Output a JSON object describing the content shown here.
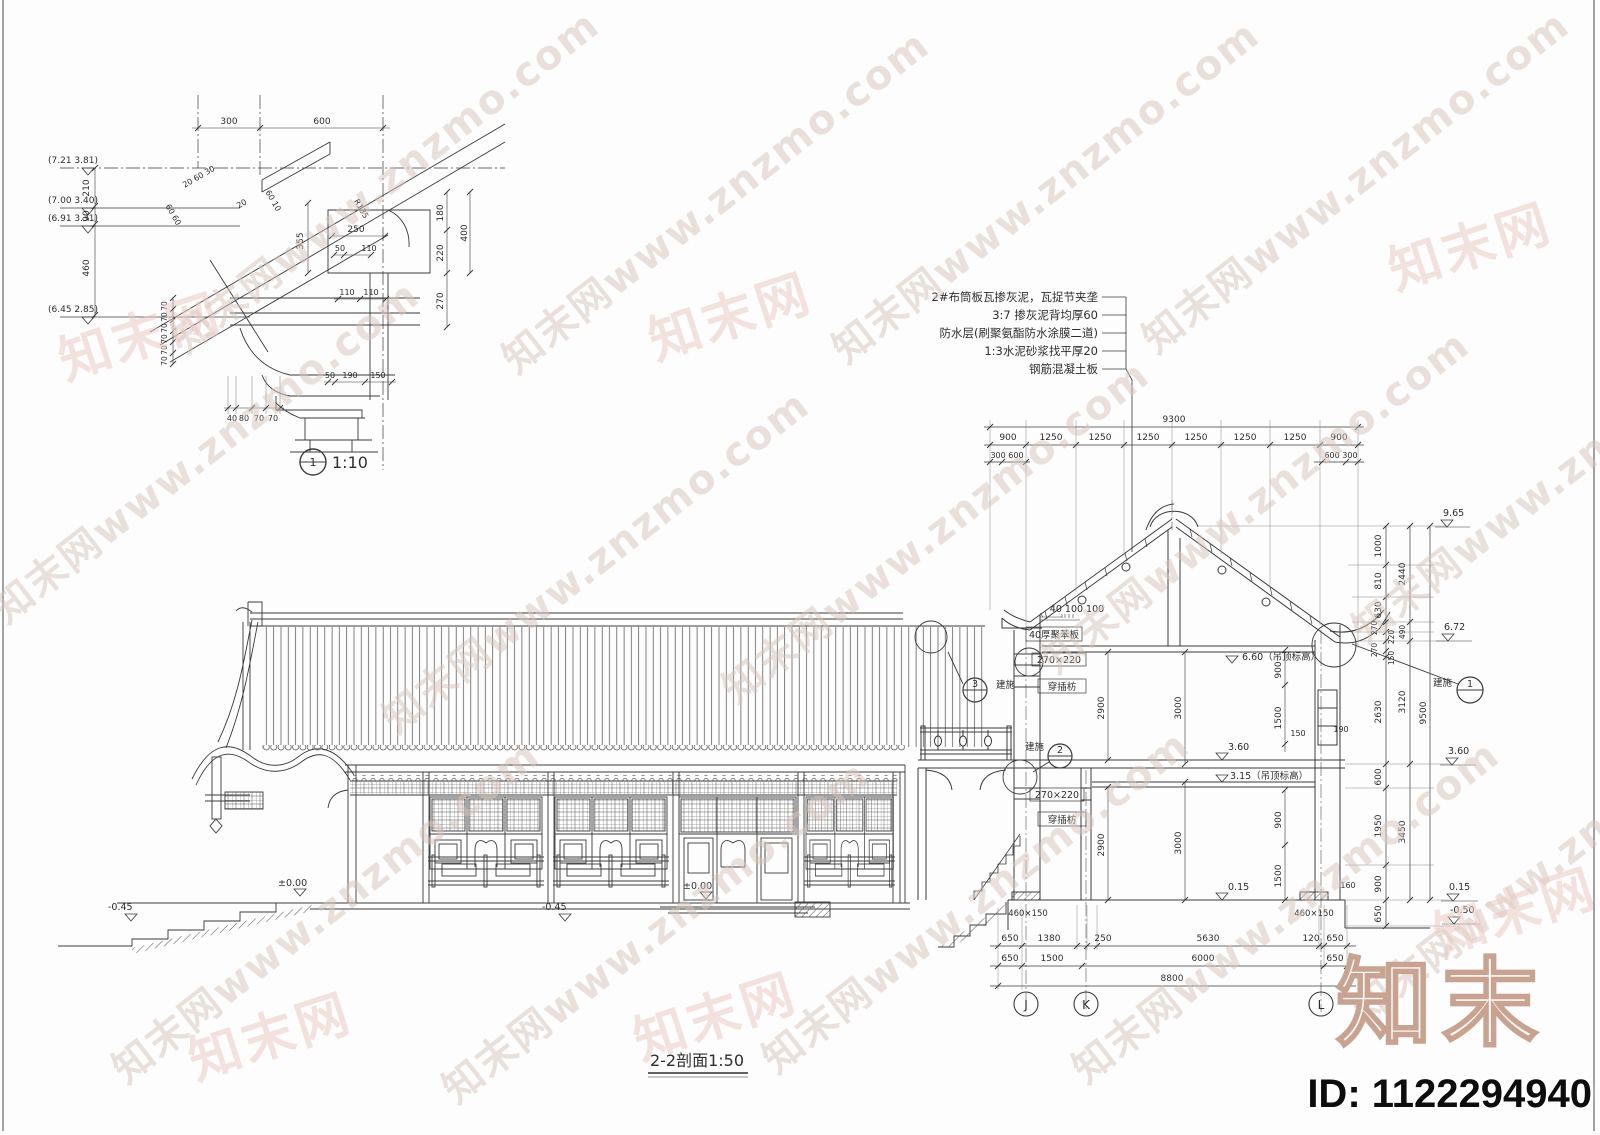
{
  "wm": {
    "t": "知末网www.znzmo.com",
    "s": "知末网"
  },
  "brand": {
    "logo": "知末",
    "id": "ID: 1122294940"
  },
  "d1": {
    "no": "1",
    "scale": "1:10",
    "lv": [
      "(7.21 3.81)",
      "(7.00 3.40)",
      "(6.91 3.31)",
      "(6.45 2.85)"
    ],
    "lc": [
      "210",
      "90",
      "460"
    ],
    "td": [
      "300",
      "600"
    ],
    "sd": [
      "20 60 30",
      "60 60",
      "20",
      "60 10",
      "R135"
    ],
    "bd": [
      "355",
      "250",
      "50",
      "110",
      "110",
      "110"
    ],
    "rc": [
      "180",
      "220",
      "400",
      "270"
    ],
    "b1": [
      "50",
      "190",
      "150"
    ],
    "b2": [
      "40",
      "80",
      "70",
      "70"
    ],
    "sv": [
      "70",
      "70",
      "70",
      "70",
      "70",
      "70"
    ]
  },
  "notes": [
    "2#布筒板瓦掺灰泥，瓦捉节夹垄",
    "3:7 掺灰泥背均厚60",
    "防水层(刷聚氨酯防水涂膜二道)",
    "1:3水泥砂浆找平厚20",
    "钢筋混凝土板"
  ],
  "sec": {
    "title": "2-2剖面1:50",
    "t0": "9300",
    "t1": [
      "900",
      "1250",
      "1250",
      "1250",
      "1250",
      "1250",
      "1250",
      "900"
    ],
    "t2": "300 600",
    "t3": "600 300",
    "ra": [
      "1000",
      "810",
      "630",
      "270",
      "220",
      "270",
      "150",
      "2630",
      "600",
      "1950",
      "900",
      "650"
    ],
    "rb": [
      "2440",
      "490",
      "3120",
      "3450"
    ],
    "rc": "9500",
    "rl": [
      "9.65",
      "6.72",
      "3.60",
      "0.15",
      "-0.50"
    ],
    "ml": [
      "6.60（吊顶标高）",
      "3.60",
      "3.15（吊顶标高）",
      "0.15"
    ],
    "fd": [
      "2900",
      "3000",
      "900",
      "1500",
      "2900",
      "3000",
      "900",
      "1500",
      "150",
      "190"
    ],
    "sm": [
      "40 100 100",
      "160"
    ],
    "lb": [
      "40厚聚苯板",
      "270×220",
      "穿插枋",
      "270×220",
      "穿插枋",
      "460×150",
      "460×150"
    ],
    "b1": [
      "650",
      "1380",
      "250",
      "5630",
      "120",
      "650"
    ],
    "b2": [
      "650",
      "1500",
      "6000",
      "650"
    ],
    "b0": "8800",
    "gr": [
      "J",
      "K",
      "L"
    ],
    "el": [
      "-0.45",
      "±0.00",
      "-0.45",
      "±0.00"
    ],
    "ref": "建施",
    "rn": [
      "1",
      "2",
      "3"
    ]
  }
}
